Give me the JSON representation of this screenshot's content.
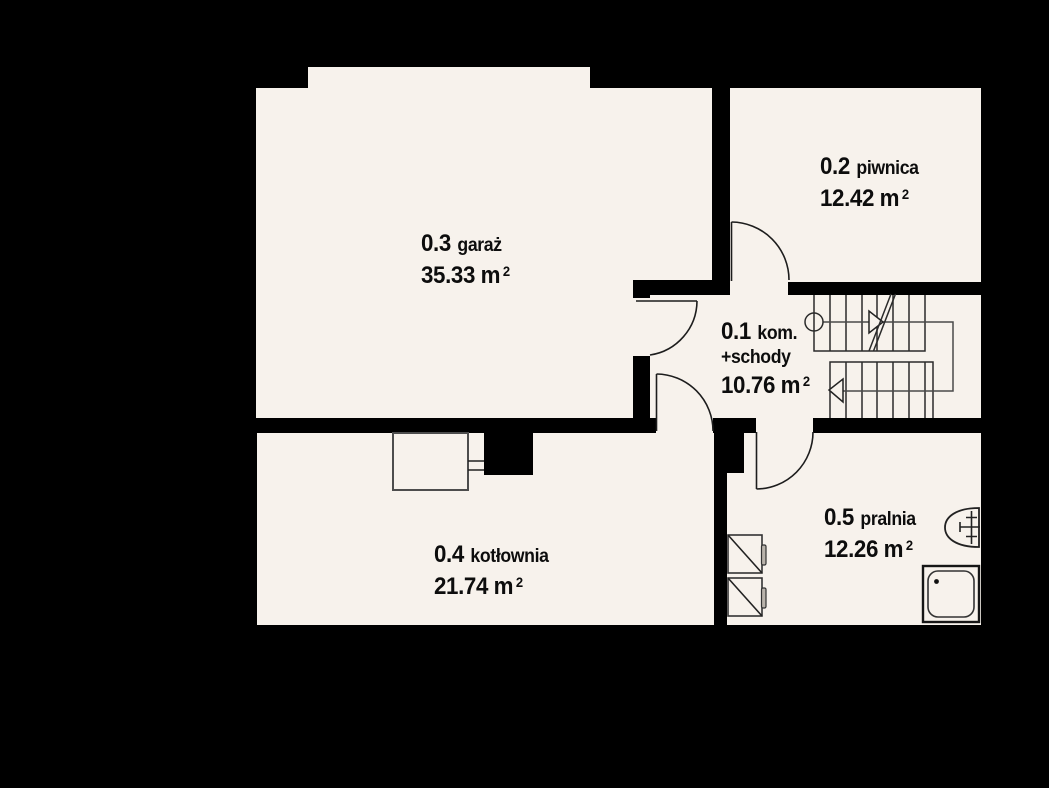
{
  "floorplan": {
    "colors": {
      "background": "#000000",
      "floor": "#f7f2ec",
      "line": "#1d1d1d"
    },
    "rooms": [
      {
        "id": "0.1",
        "name": "kom.",
        "name_line2": "+schody",
        "area": "10.76",
        "unit": "m",
        "sup": "2"
      },
      {
        "id": "0.2",
        "name": "piwnica",
        "area": "12.42",
        "unit": "m",
        "sup": "2"
      },
      {
        "id": "0.3",
        "name": "garaż",
        "area": "35.33",
        "unit": "m",
        "sup": "2"
      },
      {
        "id": "0.4",
        "name": "kotłownia",
        "area": "21.74",
        "unit": "m",
        "sup": "2"
      },
      {
        "id": "0.5",
        "name": "pralnia",
        "area": "12.26",
        "unit": "m",
        "sup": "2"
      }
    ]
  }
}
